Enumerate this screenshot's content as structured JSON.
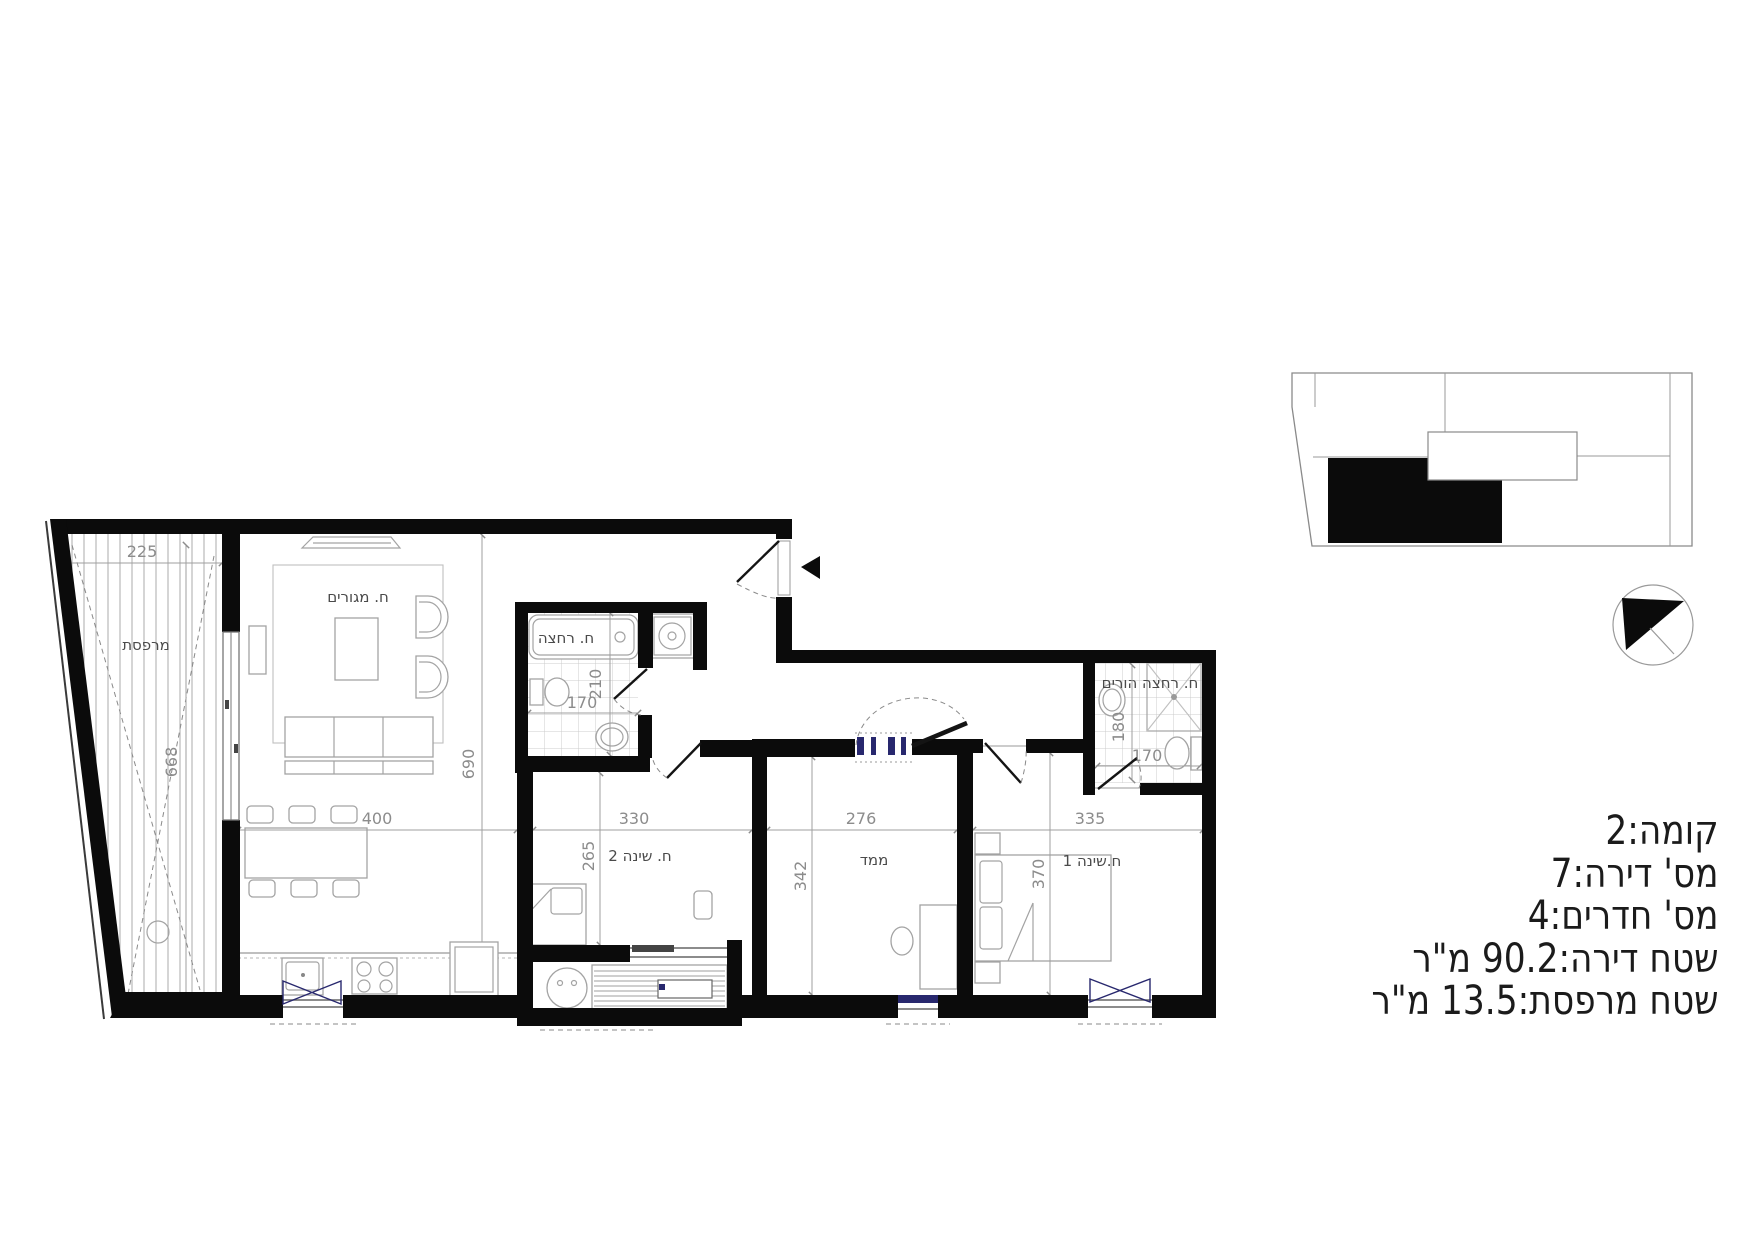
{
  "colors": {
    "wall": "#0b0b0b",
    "dim_text": "#8c8c8c",
    "label_text": "#4a4a4a",
    "furniture_line": "#a3a3a3",
    "tile_line": "#cccccc",
    "window_accent": "#28286e",
    "info_text": "#1b1b1b"
  },
  "info_panel": {
    "lines": [
      "קומה:2",
      "מס' דירה:7",
      "מס' חדרים:4",
      "שטח דירה:90.2 מ\"ר",
      "שטח מרפסת:13.5 מ\"ר"
    ]
  },
  "plan": {
    "rooms": {
      "balcony": {
        "label": "מרפסת",
        "width": "225",
        "depth": "668"
      },
      "living": {
        "label": "ח. מגורים",
        "width": "400",
        "depth": "690"
      },
      "bathroom": {
        "label": "ח. רחצה",
        "width": "170",
        "depth": "210"
      },
      "bedroom2": {
        "label": "ח. שינה 2",
        "width": "330",
        "depth": "265"
      },
      "mamad": {
        "label": "ממד",
        "width": "276",
        "depth": "342"
      },
      "bedroom1": {
        "label": "ח.שינה 1",
        "width": "335",
        "depth": "370"
      },
      "parents_bathroom": {
        "label": "ח. רחצה הורים",
        "width": "170",
        "depth": "180"
      }
    }
  }
}
